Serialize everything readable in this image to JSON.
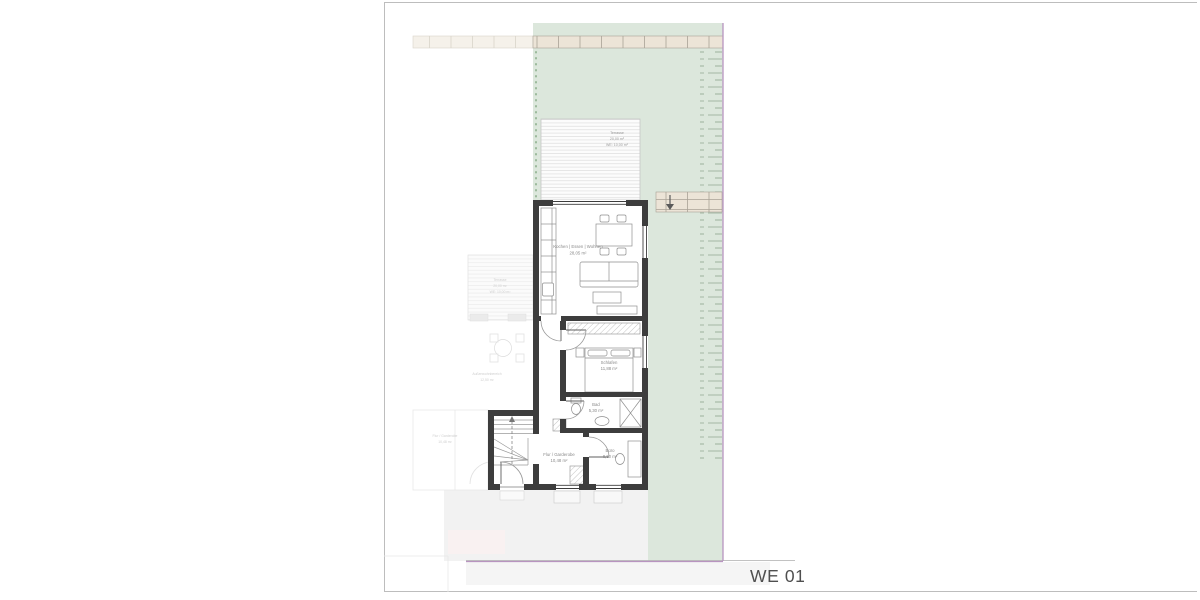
{
  "plan": {
    "sheet": {
      "label": "WE 01"
    },
    "colors": {
      "garden": "#dce7dc",
      "wall": "#3d3d3d",
      "boundary": "#b894c0",
      "paving": "#ece4d7",
      "paving_light": "#f5f1ea",
      "hedge": "#a3b7a3",
      "driveway": "#f2f2f2"
    },
    "terrace": {
      "line1": "Terrasse",
      "line2": "20,00 m²",
      "line3": "WE: 10,00 m²"
    },
    "rooms": {
      "living": {
        "name": "Kochen | Essen | Wohnen",
        "area": "28,05 m²"
      },
      "bedroom": {
        "name": "Schlafen",
        "area": "11,88 m²"
      },
      "bath": {
        "name": "Bad",
        "area": "5,30 m²"
      },
      "office": {
        "name": "Büro",
        "area": "8,60 m²"
      },
      "hall": {
        "name": "Flur / Garderobe",
        "area": "10,48 m²"
      }
    },
    "neighbor": {
      "terrace": {
        "line1": "Terrasse",
        "line2": "20,00 m²",
        "line3": "WE: 10,00 m²"
      },
      "outdoor": {
        "line1": "Außenwohnbereich",
        "line2": "12,50 m²"
      },
      "hall": {
        "line1": "Flur / Garderobe",
        "line2": "10,48 m²"
      }
    }
  }
}
